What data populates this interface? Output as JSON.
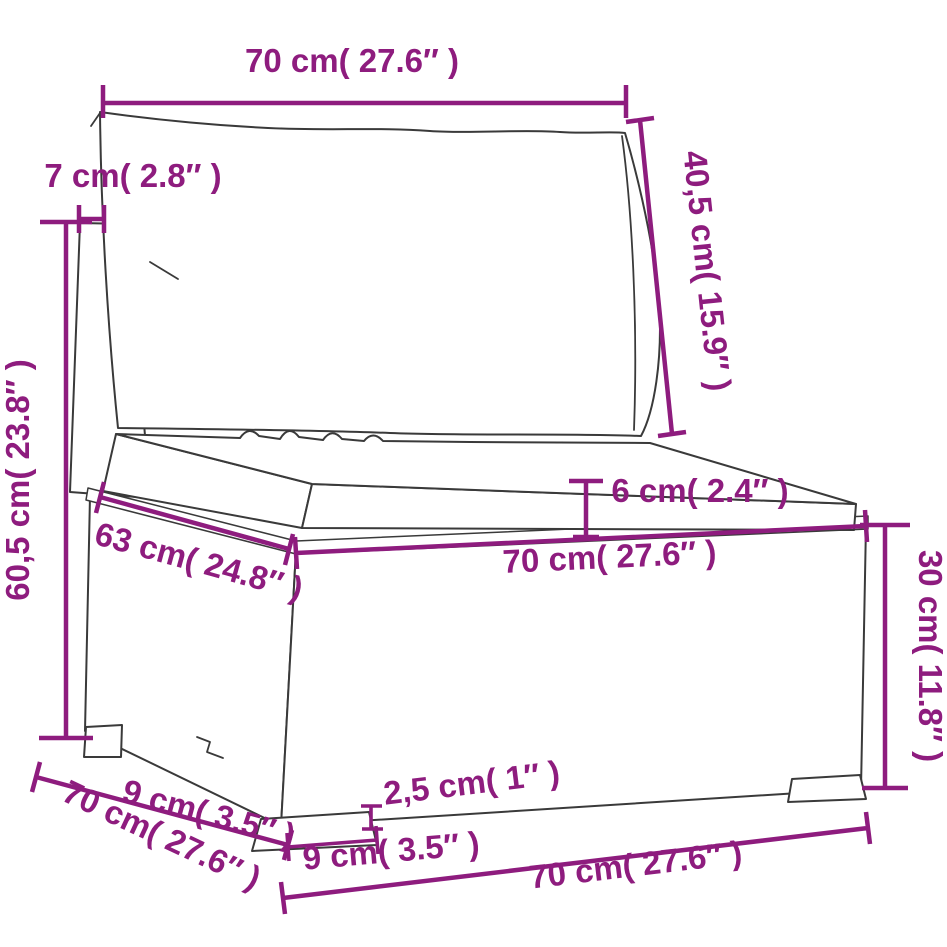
{
  "canvas": {
    "width": 947,
    "height": 947,
    "background": "#ffffff"
  },
  "diagram": {
    "type": "furniture-dimension-diagram",
    "subject": "poly rattan middle sofa section with back cushion and seat cushion",
    "accent_color": "#8e1c7e",
    "line_color": "#3a3a3a",
    "dimensions": {
      "back_width": "70 cm( 27.6″ )",
      "back_panel_thickness": "7 cm( 2.8″ )",
      "total_height": "60,5 cm( 23.8″ )",
      "back_cushion_height": "40,5 cm( 15.9″ )",
      "seat_cushion_thickness": "6 cm( 2.4″ )",
      "seat_depth": "63 cm( 24.8″ )",
      "seat_front_width": "70 cm( 27.6″ )",
      "base_height": "30 cm( 11.8″ )",
      "leg_height": "2,5 cm( 1″ )",
      "foot_width": "9 cm( 3.5″ )",
      "foot_depth": "9 cm( 3.5″ )",
      "base_bottom_width": "70 cm( 27.6″ )"
    }
  }
}
